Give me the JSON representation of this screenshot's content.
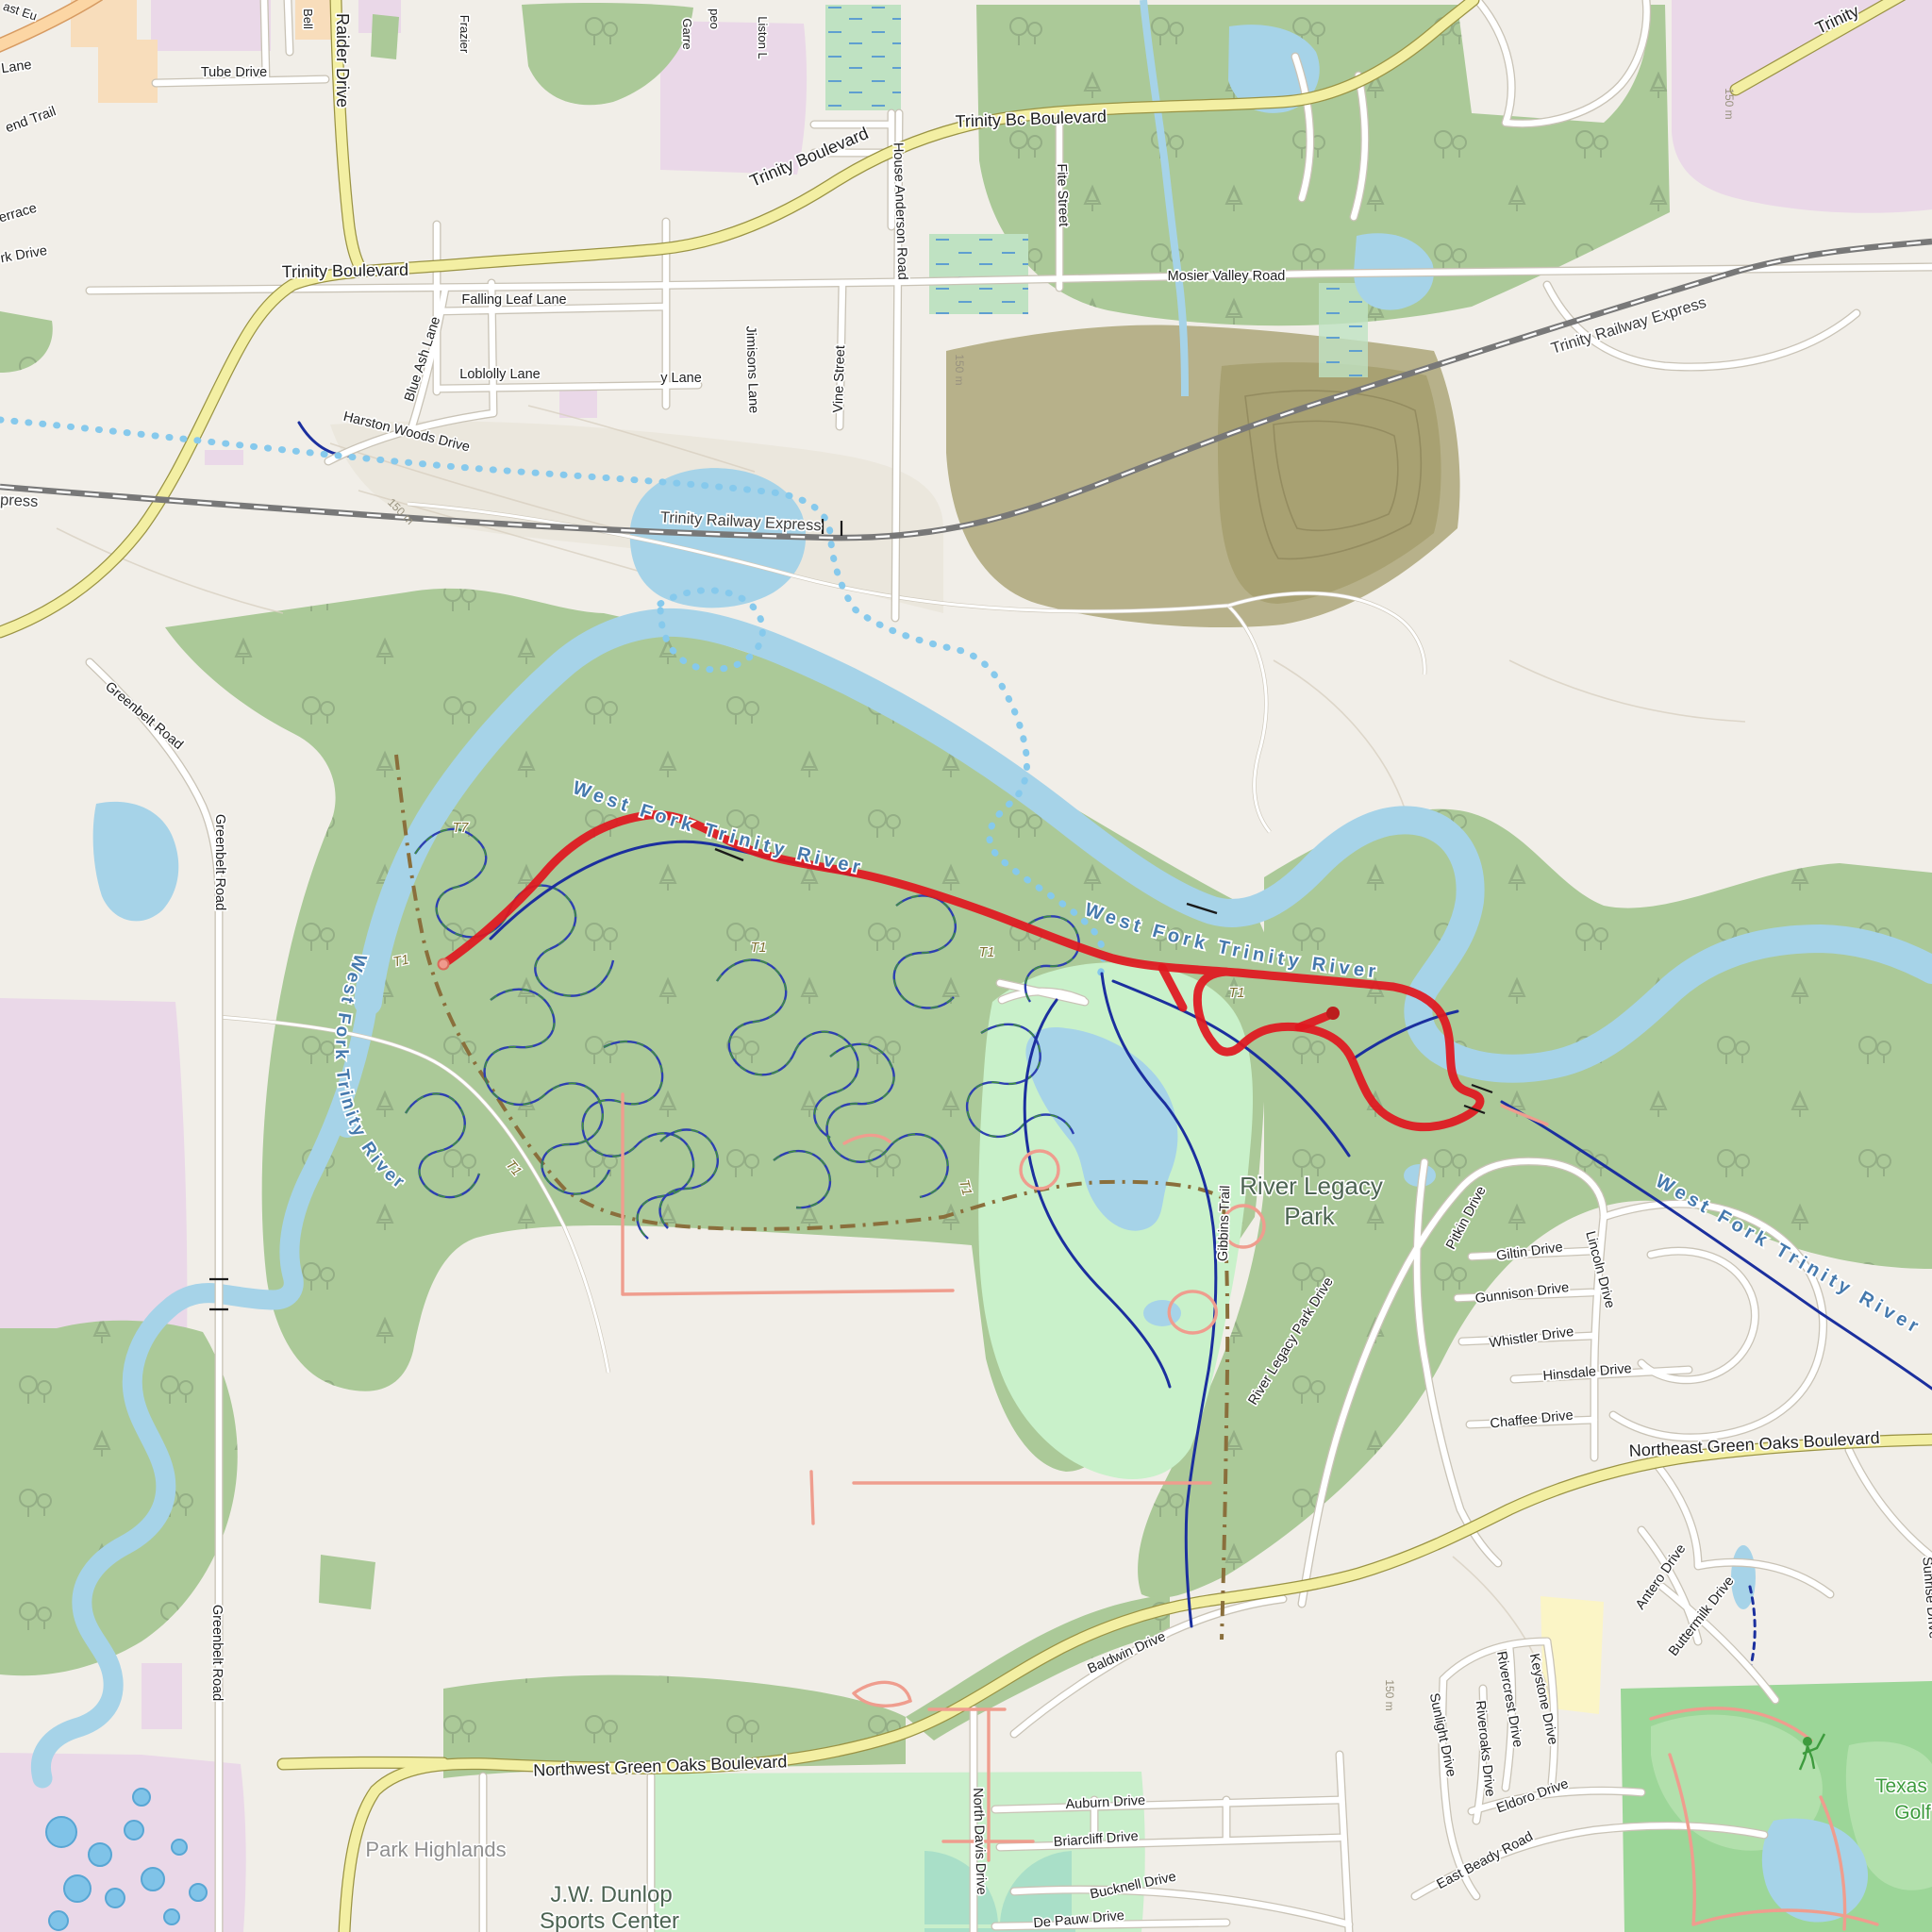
{
  "map": {
    "roads": {
      "trinity_blvd": "Trinity Boulevard",
      "trinity_ghost": "Trinity Bc Boulevard",
      "trinity_frag": "Trinity",
      "raider": "Raider Drive",
      "tube": "Tube Drive",
      "bell": "Bell",
      "frazier": "Frazier",
      "garrett": "Garre",
      "peo": "peo",
      "liston": "Liston L",
      "east_euless_frag": "ast Eu",
      "lane_frag": "Lane",
      "bend_trail_frag": "end Trail",
      "terrace_frag": "errace",
      "park_drive_frag": "rk Drive",
      "falling_leaf": "Falling Leaf Lane",
      "loblolly": "Loblolly Lane",
      "loblolly_frag": "y Lane",
      "blue_ash": "Blue Ash Lane",
      "harston": "Harston Woods Drive",
      "jimisons": "Jimisons Lane",
      "vine": "Vine Street",
      "house_anderson": "House Anderson Road",
      "fite": "Fite Street",
      "mosier": "Mosier Valley Road",
      "greenbelt": "Greenbelt Road",
      "nw_green_oaks": "Northwest Green Oaks Boulevard",
      "ne_green_oaks": "Northeast Green Oaks Boulevard",
      "river_legacy_dr": "River Legacy Park Drive",
      "gibbins": "Gibbins Trail",
      "pitkin": "Pitkin Drive",
      "giltin": "Giltin Drive",
      "lincoln": "Lincoln Drive",
      "gunnison": "Gunnison Drive",
      "whistler": "Whistler Drive",
      "hinsdale": "Hinsdale Drive",
      "chaffee": "Chaffee Drive",
      "baldwin": "Baldwin Drive",
      "north_davis": "North Davis Drive",
      "auburn": "Auburn Drive",
      "briarcliff": "Briarcliff Drive",
      "bucknell": "Bucknell Drive",
      "de_pauw": "De Pauw Drive",
      "sunlight": "Sunlight Drive",
      "riveroaks": "Riveroaks Drive",
      "rivercrest": "Rivercrest Drive",
      "keystone": "Keystone Drive",
      "eldoro": "Eldoro Drive",
      "east_beady": "East Beady Road",
      "antero": "Antero Drive",
      "buttermilk": "Buttermilk Drive",
      "sunrise": "Sunrise Drive"
    },
    "railway": {
      "name": "Trinity Railway Express",
      "name_frag": "press"
    },
    "water": {
      "river": "West Fork Trinity River"
    },
    "places": {
      "park_l1": "River Legacy",
      "park_l2": "Park",
      "sports_l1": "J.W. Dunlop",
      "sports_l2": "Sports Center",
      "neighborhood": "Park Highlands",
      "golf_l1": "Texas Rangers",
      "golf_l2": "Golf Club"
    },
    "trails": {
      "t1": "T1",
      "t7": "T7"
    },
    "contours": {
      "elev_150": "150 m"
    },
    "route": {
      "color": "#e0181f"
    }
  }
}
